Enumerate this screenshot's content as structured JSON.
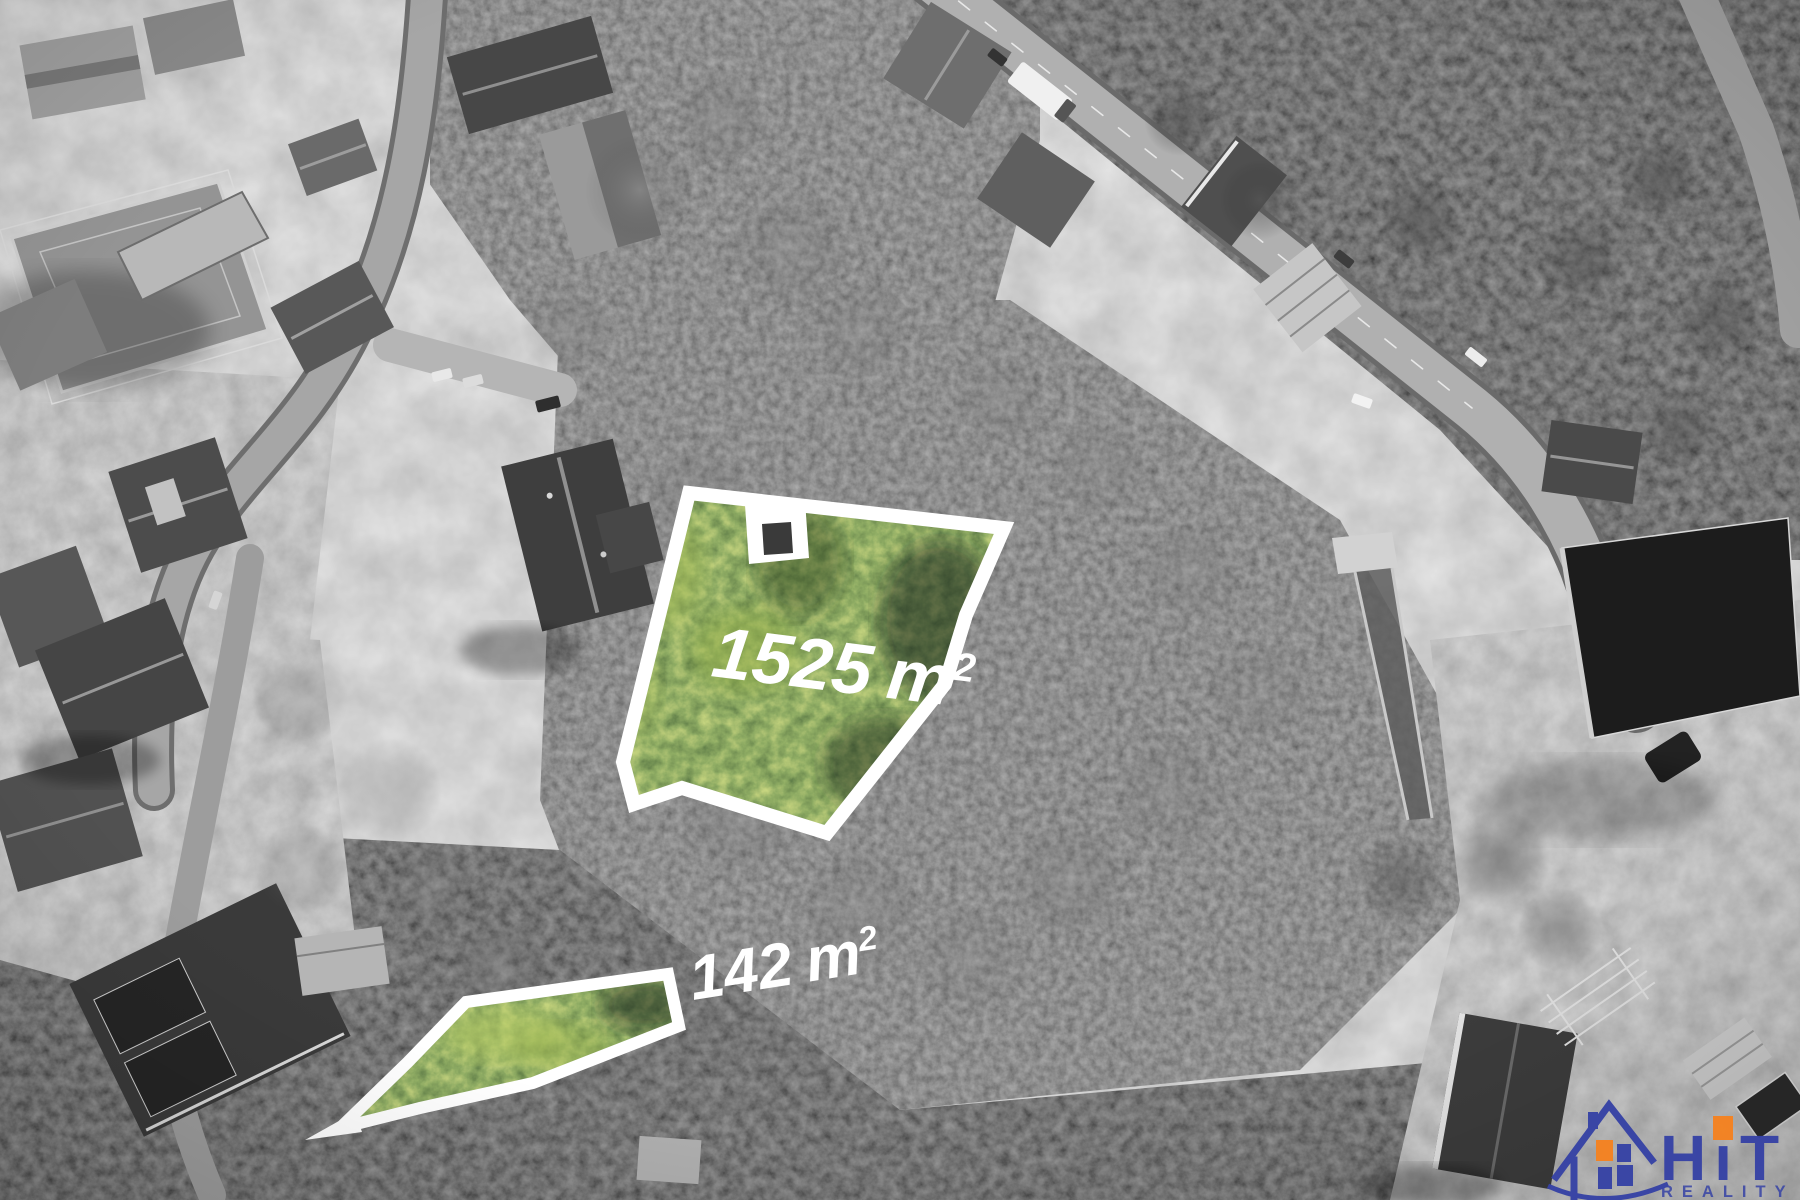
{
  "plots": [
    {
      "id": "plot-main",
      "number": "1525",
      "unit": "m",
      "sup": "2",
      "label": "1525 m²"
    },
    {
      "id": "plot-strip",
      "number": "142",
      "unit": "m",
      "sup": "2",
      "label": "142 m²"
    }
  ],
  "logo": {
    "brand": "HiT",
    "tagline": "REALITY",
    "icon": "house-icon",
    "colors": {
      "blue": "#3642a5",
      "orange": "#f58220"
    }
  },
  "colors": {
    "plot_outline": "#ffffff",
    "label_text": "#ffffff",
    "highlight_green": "#5d7733"
  }
}
